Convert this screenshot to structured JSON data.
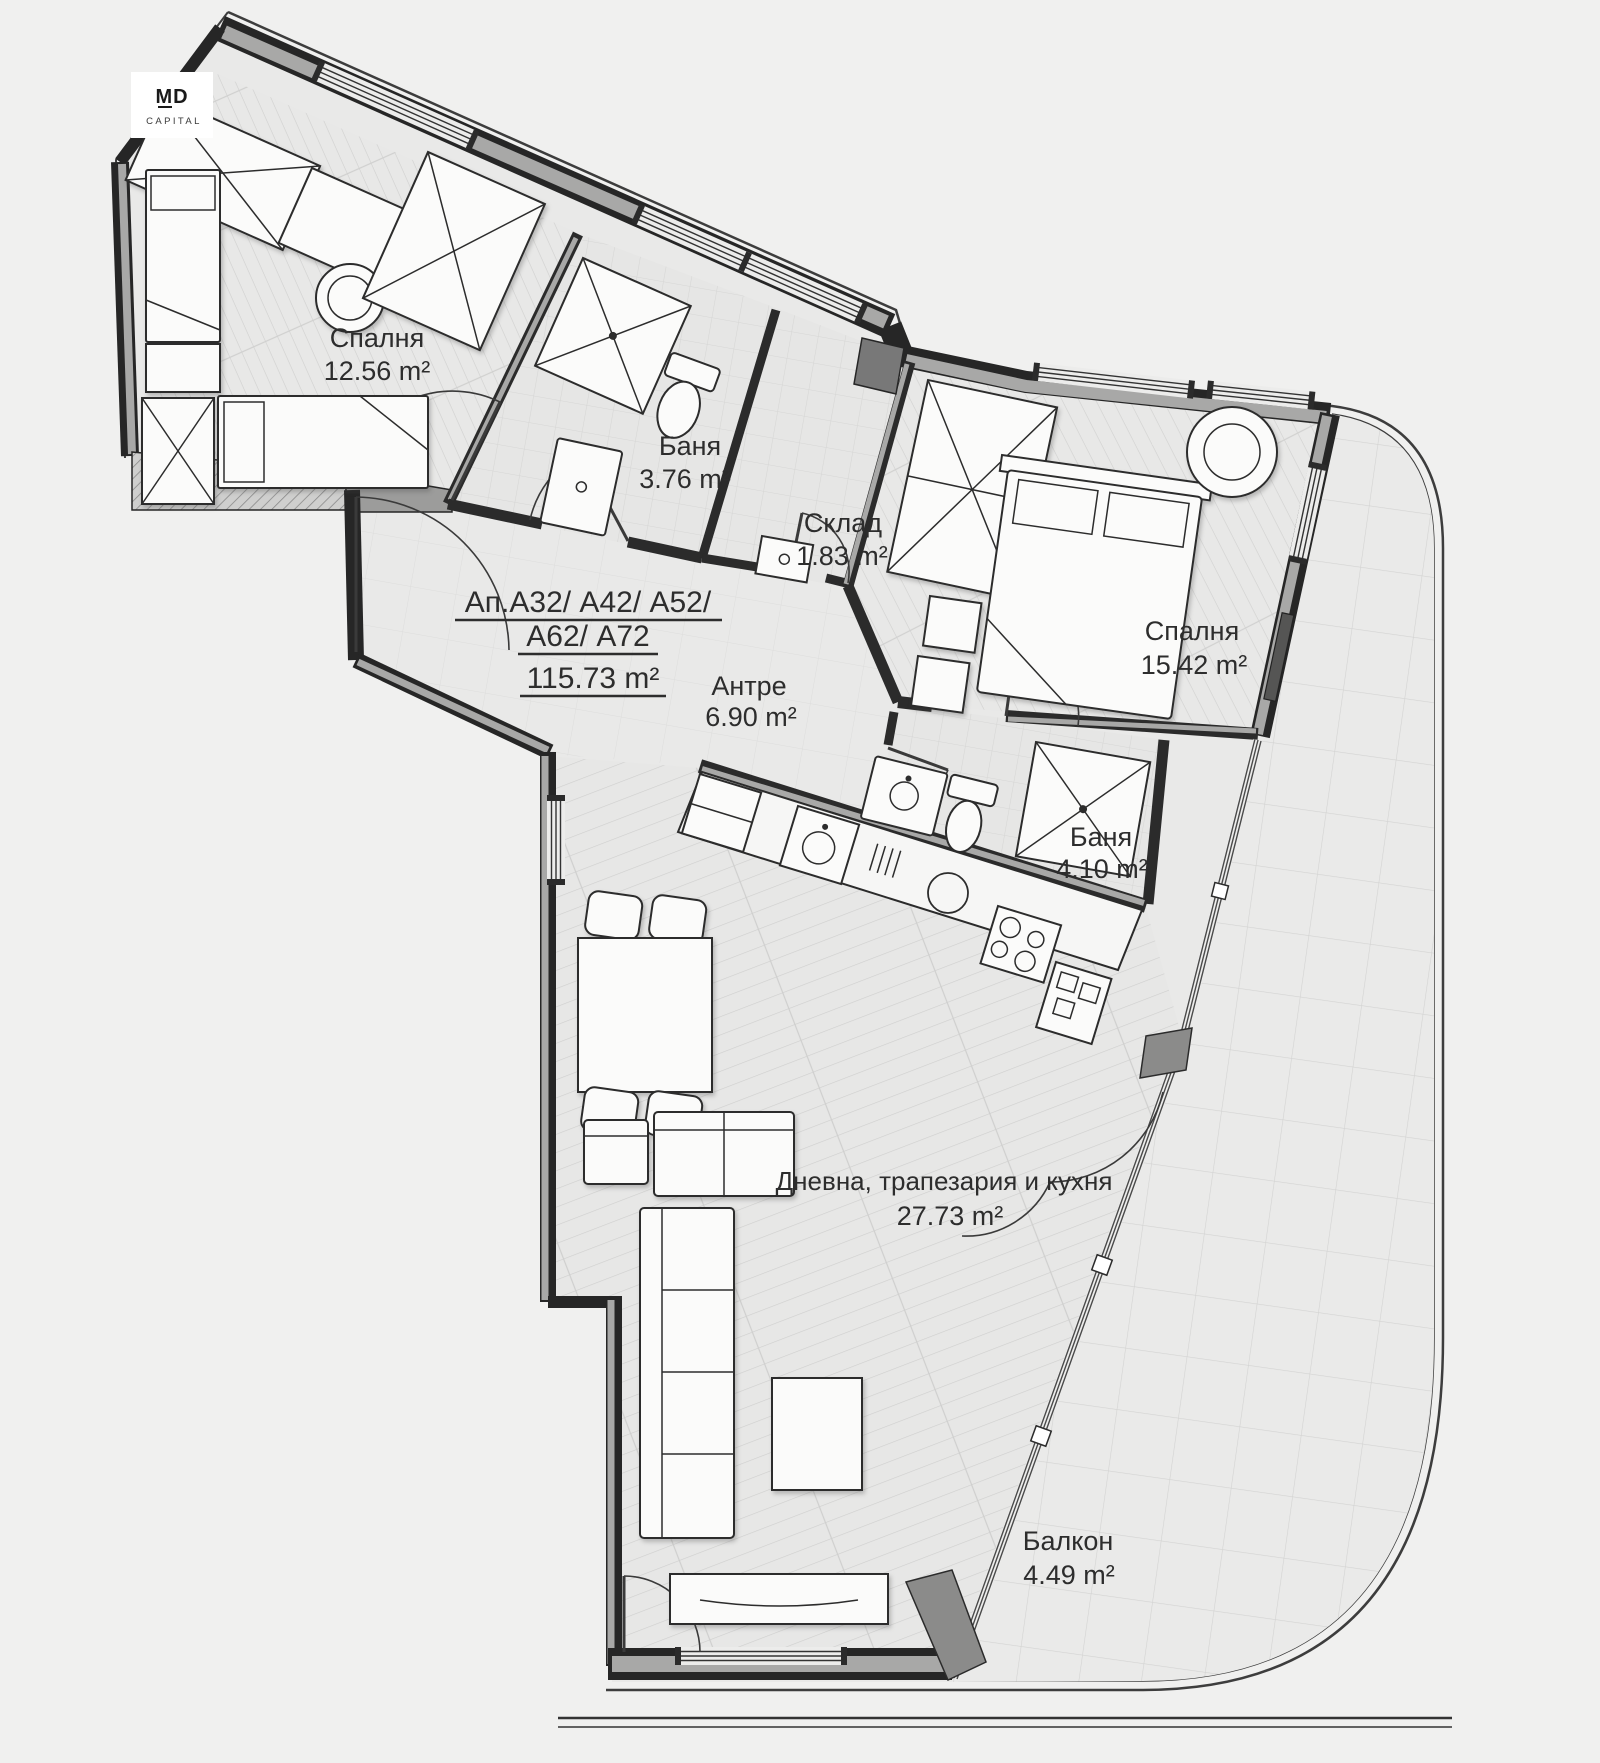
{
  "logo": {
    "brand_top": "MD",
    "brand_bottom": "CAPITAL"
  },
  "plan": {
    "id_line1": "Ап.А32/ А42/ А52/",
    "id_line2": "А62/ А72",
    "total_area": "115.73 m²"
  },
  "rooms": {
    "bedroom1": {
      "name": "Спалня",
      "area": "12.56 m²"
    },
    "bath1": {
      "name": "Баня",
      "area": "3.76 m²"
    },
    "storage": {
      "name": "Склад",
      "area": "1.83 m²"
    },
    "hall": {
      "name": "Антре",
      "area": "6.90 m²"
    },
    "bedroom2": {
      "name": "Спалня",
      "area": "15.42 m²"
    },
    "bath2": {
      "name": "Баня",
      "area": "4.10 m²"
    },
    "living": {
      "name": "Дневна, трапезария и кухня",
      "area": "27.73 m²"
    },
    "balcony": {
      "name": "Балкон",
      "area": "4.49 m²"
    }
  },
  "colors": {
    "background": "#f0f0ef",
    "wall": "#262626",
    "wall_fill": "#a8a8a7",
    "floor": "#e9e9e8",
    "tile_line": "#d8d8d7",
    "furniture": "#fbfbfa",
    "glass": "#4a4a4a",
    "text": "#2d2d2d"
  }
}
